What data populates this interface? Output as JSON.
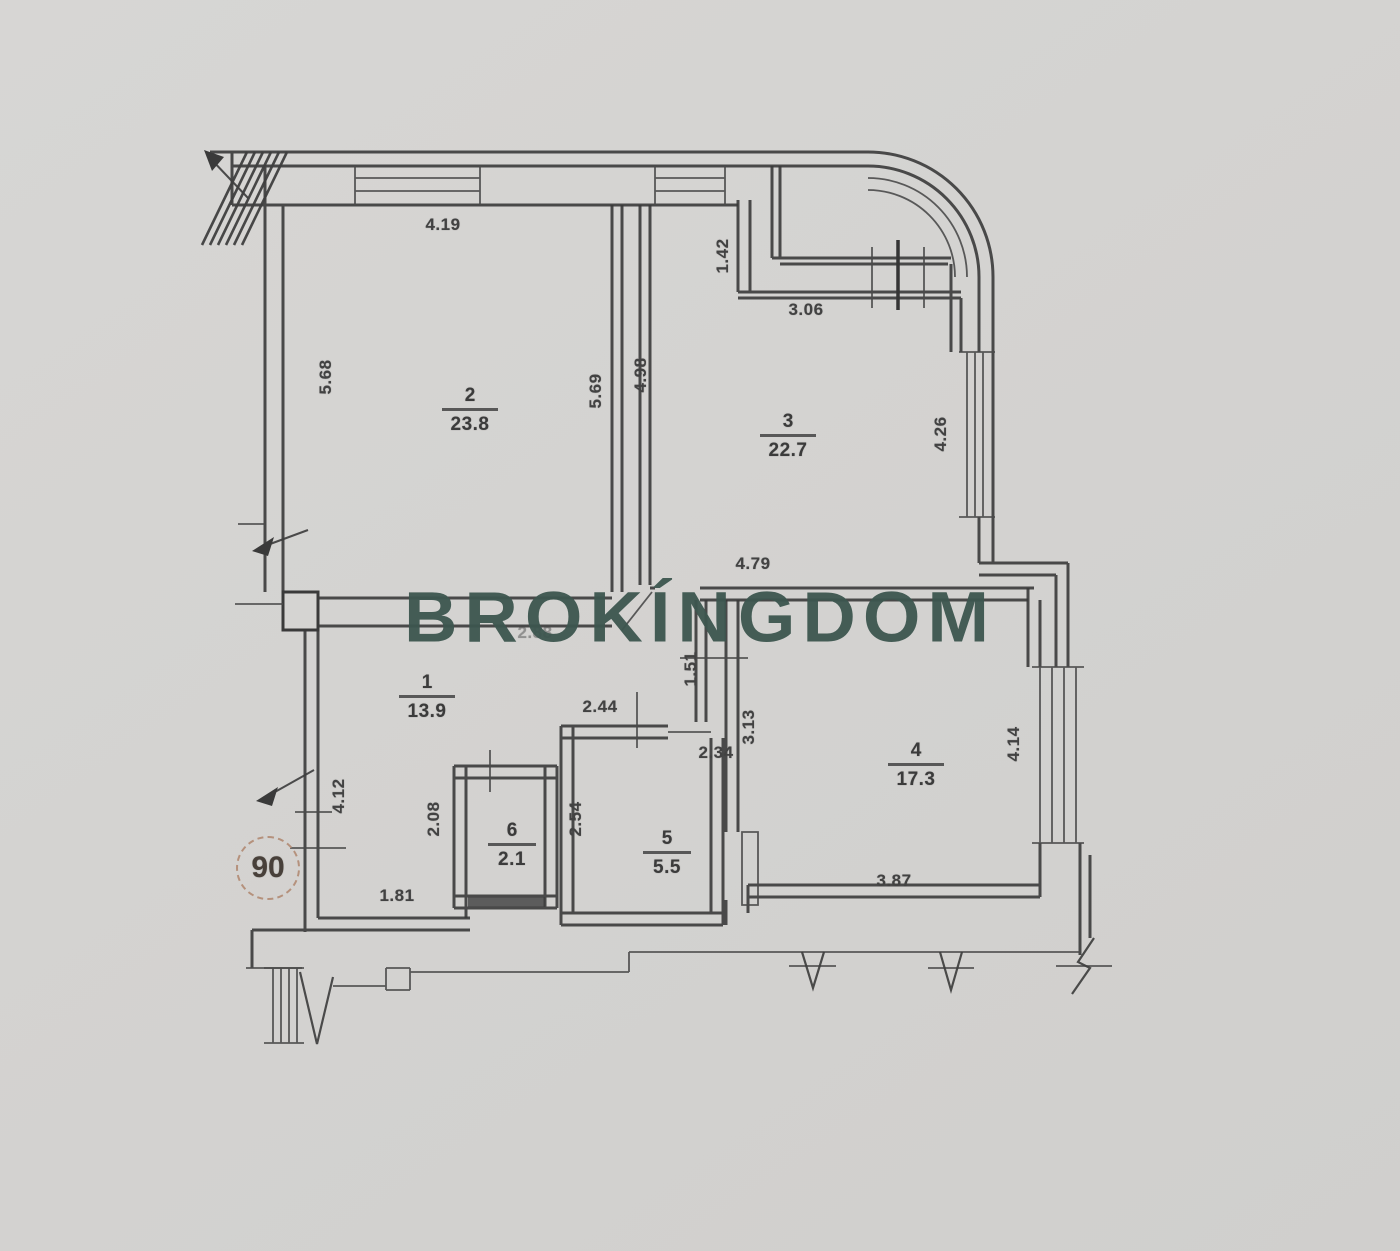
{
  "watermark": {
    "text": "BROKÍNGDOM"
  },
  "badge": {
    "value": "90"
  },
  "rooms": {
    "room1": {
      "number": "1",
      "area": "13.9"
    },
    "room2": {
      "number": "2",
      "area": "23.8"
    },
    "room3": {
      "number": "3",
      "area": "22.7"
    },
    "room4": {
      "number": "4",
      "area": "17.3"
    },
    "room5": {
      "number": "5",
      "area": "5.5"
    },
    "room6": {
      "number": "6",
      "area": "2.1"
    }
  },
  "dimensions": {
    "top_width": "4.19",
    "left_upper": "5.68",
    "room2_right": "5.69",
    "room3_left": "4.98",
    "niche_height": "1.42",
    "niche_width": "3.06",
    "room3_right": "4.26",
    "room3_bottom": "4.79",
    "corridor_width": "2.88",
    "passage_height": "1.51",
    "room5_top": "2.44",
    "room5_door": "2.34",
    "room4_left": "3.13",
    "room6_left": "2.08",
    "room5_left": "2.54",
    "corridor_left": "4.12",
    "corridor_bottom": "1.81",
    "room4_bottom": "3.87",
    "room4_right": "4.14"
  },
  "colors": {
    "paper": "#d4d3d1",
    "ink": "#3a3a3a",
    "watermark": "#3d564f",
    "badge_ring": "#b5917c"
  }
}
